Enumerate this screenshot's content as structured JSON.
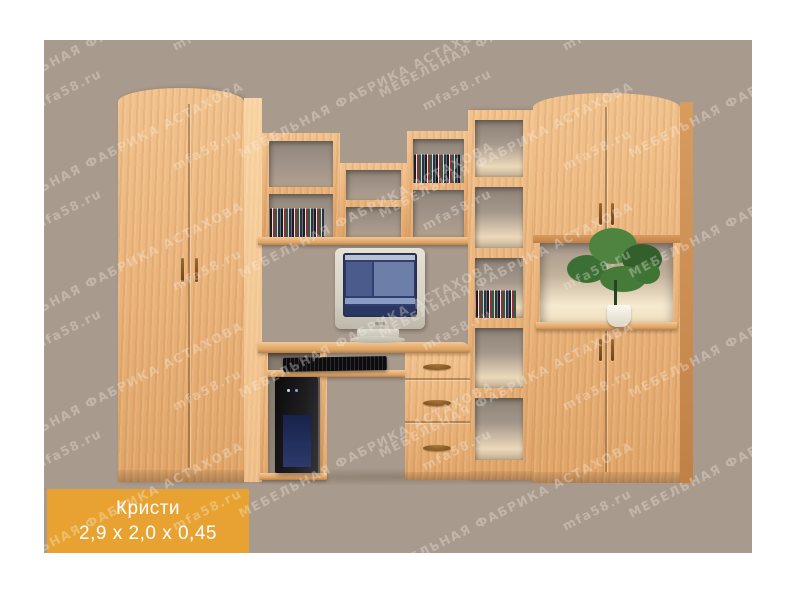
{
  "product": {
    "name": "Кристи",
    "dimensions": "2,9 x 2,0 x 0,45"
  },
  "watermark": {
    "brand": "МЕБЕЛЬНАЯ ФАБРИКА АСТАХОВА",
    "site": "mfa58.ru"
  },
  "colors": {
    "background": "#a89a8c",
    "wood": "#ecb47c",
    "label_bg": "#e7a232",
    "label_text": "#ffffff"
  }
}
